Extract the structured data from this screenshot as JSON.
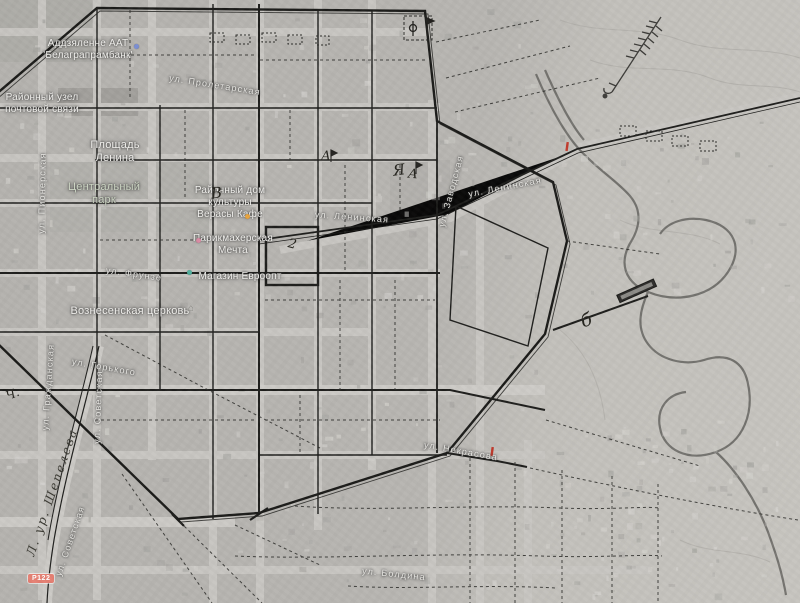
{
  "map": {
    "pois": [
      {
        "lines": [
          "Аддзяленне ААТ",
          "'Белаграпрамбанк'"
        ]
      },
      {
        "lines": [
          "Районный узел",
          "почтовой связи"
        ]
      },
      {
        "lines": [
          "Площадь",
          "Ленина"
        ]
      },
      {
        "lines": [
          "Центральный",
          "парк"
        ]
      },
      {
        "lines": [
          "Районный дом",
          "культуры",
          "Верасы Кафе"
        ]
      },
      {
        "lines": [
          "Парикмахерская",
          "Мечта"
        ]
      },
      {
        "lines": [
          "Магазин Евроопт"
        ]
      },
      {
        "lines": [
          "Вознесенская церковь"
        ]
      }
    ],
    "streets": [
      "ул. Пролетарская",
      "ул. Пионерская",
      "ул. Фрунзе",
      "ул. Ленинская",
      "ул. Ленинская",
      "ул. Заводская",
      "ул. Горького",
      "ул. Гражданская",
      "ул. Советская",
      "ул. Советская",
      "ул. Некрасова",
      "ул. Болдина"
    ],
    "annotations": {
      "marks": [
        "А",
        "Я",
        "А",
        "В",
        "2",
        "б",
        "Ч."
      ],
      "ravine": "Л. ур. Шепелева"
    },
    "shield": {
      "text": "Р122"
    },
    "icons": {
      "church_glyph": "⌂"
    },
    "colors": {
      "shield_bg": "#e57f72",
      "plan_line": "#1b1b19",
      "river": "#6b6a66",
      "label": "#f1f0ed",
      "park_label": "#ccd5c3"
    }
  }
}
